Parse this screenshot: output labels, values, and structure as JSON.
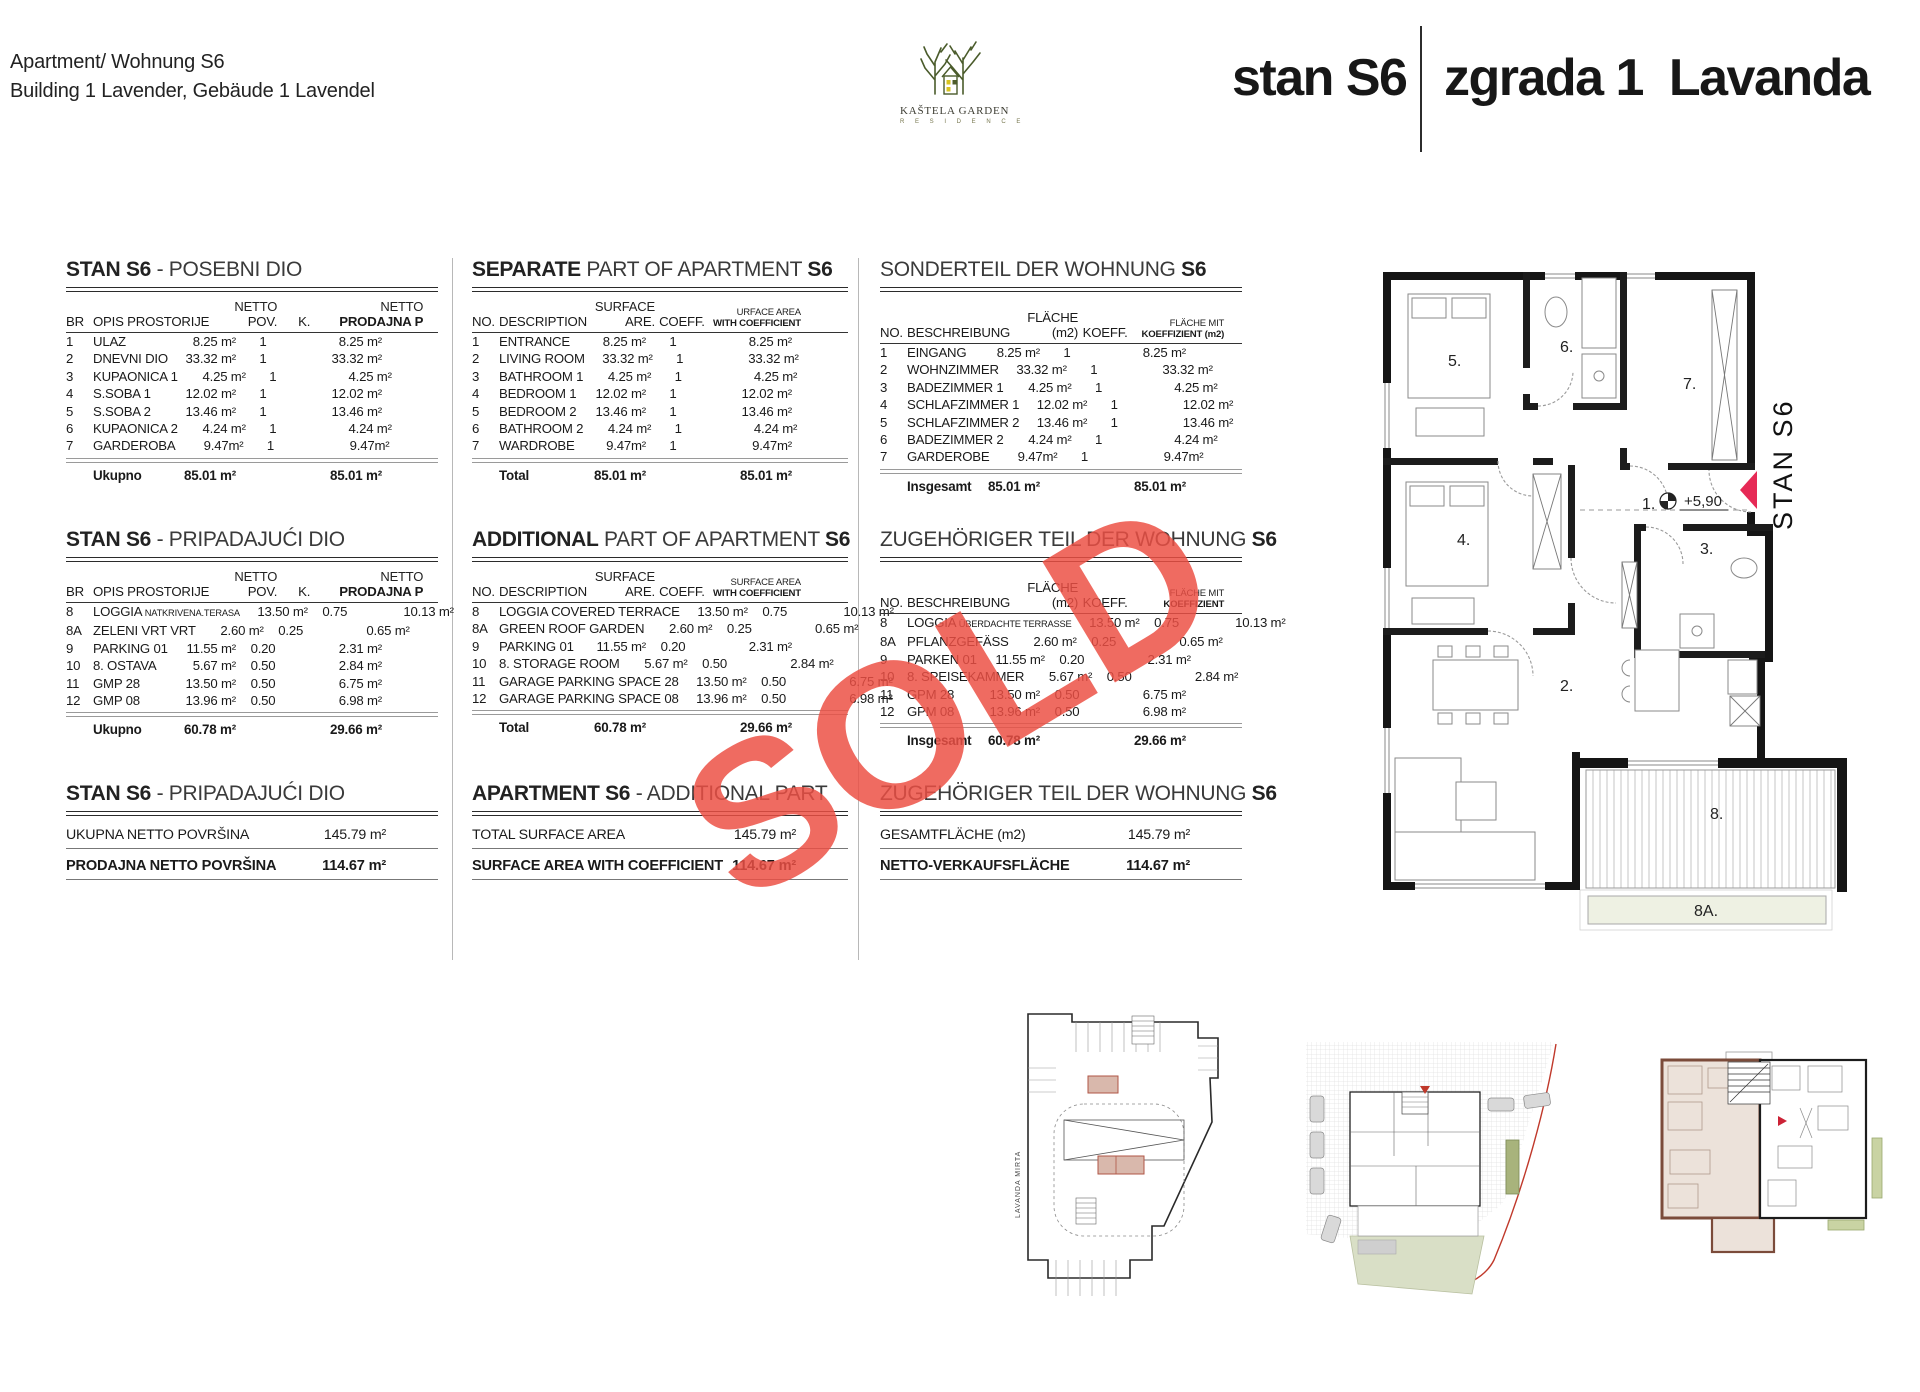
{
  "header": {
    "left_line1": "Apartment/ Wohnung S6",
    "left_line2": "Building 1 Lavender, Gebäude 1 Lavendel",
    "logo": {
      "line1": "KAŠTELA GARDEN",
      "line2": "R E S I D E N C E"
    },
    "title_unit": "stan S6",
    "title_building": "zgrada 1  Lavanda"
  },
  "watermark": {
    "text": "SOLD",
    "color": "#ec4f44"
  },
  "colors": {
    "sold_red": "#ec4f44",
    "marker_pink": "#e62a56",
    "logo_green": "#4a5b2b",
    "key_highlight_wall": "#7b4b3a",
    "key_highlight_fill": "#ece2da",
    "site_green": "#d9dfc6",
    "boundary_red": "#c0392b",
    "garage_highlight": "#d9b8ac"
  },
  "floorplan": {
    "unit_label": "STAN S6",
    "level": "+5,90",
    "rooms": {
      "r1": "1.",
      "r2": "2.",
      "r3": "3.",
      "r4": "4.",
      "r5": "5.",
      "r6": "6.",
      "r7": "7.",
      "r8": "8.",
      "r8a": "8A."
    }
  },
  "thumbnails": {
    "street_vertical": "LAVANDA    MIRTA"
  },
  "area_tables": [
    {
      "id": "hr-separate",
      "col": "hr",
      "row": "t1",
      "lang": "hr",
      "wc_small": false,
      "title": [
        {
          "t": "STAN S6",
          "b": true
        },
        {
          "t": " - POSEBNI DIO",
          "b": false
        }
      ],
      "headers": {
        "no": "BR",
        "desc": "OPIS PROSTORIJE",
        "surface_top": "NETTO",
        "surface": "POV.",
        "coeff": "K.",
        "wc_top": "NETTO",
        "wc": "PRODAJNA P"
      },
      "rows": [
        [
          "1",
          "ULAZ",
          "",
          "8.25 m²",
          "1",
          "8.25 m²"
        ],
        [
          "2",
          "DNEVNI DIO",
          "",
          "33.32 m²",
          "1",
          "33.32 m²"
        ],
        [
          "3",
          "KUPAONICA 1",
          "",
          "4.25 m²",
          "1",
          "4.25 m²"
        ],
        [
          "4",
          "S.SOBA 1",
          "",
          "12.02 m²",
          "1",
          "12.02 m²"
        ],
        [
          "5",
          "S.SOBA 2",
          "",
          "13.46 m²",
          "1",
          "13.46 m²"
        ],
        [
          "6",
          "KUPAONICA 2",
          "",
          "4.24 m²",
          "1",
          "4.24 m²"
        ],
        [
          "7",
          "GARDEROBA",
          "",
          "9.47m²",
          "1",
          "9.47m²"
        ]
      ],
      "total": {
        "label": "Ukupno",
        "surface": "85.01 m²",
        "wc": "85.01 m²"
      }
    },
    {
      "id": "en-separate",
      "col": "en",
      "row": "t1",
      "lang": "en",
      "wc_small": true,
      "title": [
        {
          "t": "SEPARATE",
          "b": true
        },
        {
          "t": " PART OF APARTMENT ",
          "b": false
        },
        {
          "t": "S6",
          "b": true
        }
      ],
      "headers": {
        "no": "NO.",
        "desc": "DESCRIPTION",
        "surface_top": "SURFACE",
        "surface": "ARE.",
        "coeff": "COEFF.",
        "wc_top": "URFACE AREA",
        "wc": "WITH COEFFICIENT"
      },
      "rows": [
        [
          "1",
          "ENTRANCE",
          "",
          "8.25 m²",
          "1",
          "8.25 m²"
        ],
        [
          "2",
          "LIVING ROOM",
          "",
          "33.32 m²",
          "1",
          "33.32 m²"
        ],
        [
          "3",
          "BATHROOM 1",
          "",
          "4.25 m²",
          "1",
          "4.25 m²"
        ],
        [
          "4",
          "BEDROOM 1",
          "",
          "12.02 m²",
          "1",
          "12.02 m²"
        ],
        [
          "5",
          "BEDROOM 2",
          "",
          "13.46 m²",
          "1",
          "13.46 m²"
        ],
        [
          "6",
          "BATHROOM 2",
          "",
          "4.24 m²",
          "1",
          "4.24 m²"
        ],
        [
          "7",
          "WARDROBE",
          "",
          "9.47m²",
          "1",
          "9.47m²"
        ]
      ],
      "total": {
        "label": "Total",
        "surface": "85.01 m²",
        "wc": "85.01 m²"
      }
    },
    {
      "id": "de-separate",
      "col": "de",
      "row": "t1",
      "lang": "de",
      "wc_small": true,
      "title": [
        {
          "t": "SONDERTEIL DER WOHNUNG ",
          "b": false
        },
        {
          "t": "S6",
          "b": true
        }
      ],
      "headers": {
        "no": "NO.",
        "desc": "BESCHREIBUNG",
        "surface_top": "",
        "surface": "FLÄCHE (m2)",
        "coeff": "KOEFF.",
        "wc_top": "FLÄCHE MIT",
        "wc": "KOEFFIZIENT (m2)"
      },
      "rows": [
        [
          "1",
          "EINGANG",
          "",
          "8.25 m²",
          "1",
          "8.25 m²"
        ],
        [
          "2",
          "WOHNZIMMER",
          "",
          "33.32 m²",
          "1",
          "33.32 m²"
        ],
        [
          "3",
          "BADEZIMMER 1",
          "",
          "4.25 m²",
          "1",
          "4.25 m²"
        ],
        [
          "4",
          "SCHLAFZIMMER 1",
          "",
          "12.02 m²",
          "1",
          "12.02 m²"
        ],
        [
          "5",
          "SCHLAFZIMMER 2",
          "",
          "13.46 m²",
          "1",
          "13.46 m²"
        ],
        [
          "6",
          "BADEZIMMER 2",
          "",
          "4.24 m²",
          "1",
          "4.24 m²"
        ],
        [
          "7",
          "GARDEROBE",
          "",
          "9.47m²",
          "1",
          "9.47m²"
        ]
      ],
      "total": {
        "label": "Insgesamt",
        "surface": "85.01 m²",
        "wc": "85.01 m²"
      }
    },
    {
      "id": "hr-additional",
      "col": "hr",
      "row": "t2",
      "lang": "hr",
      "wc_small": false,
      "title": [
        {
          "t": "STAN S6",
          "b": true
        },
        {
          "t": " - PRIPADAJUĆI DIO",
          "b": false
        }
      ],
      "headers": {
        "no": "BR",
        "desc": "OPIS PROSTORIJE",
        "surface_top": "NETTO",
        "surface": "POV.",
        "coeff": "K.",
        "wc_top": "NETTO",
        "wc": "PRODAJNA P"
      },
      "rows": [
        [
          "8",
          "LOGGIA",
          "NATKRIVENA.TERASA",
          "13.50 m²",
          "0.75",
          "10.13 m²"
        ],
        [
          "8A",
          "ZELENI VRT VRT",
          "",
          "2.60 m²",
          "0.25",
          "0.65 m²"
        ],
        [
          "9",
          "PARKING 01",
          "",
          "11.55 m²",
          "0.20",
          "2.31 m²"
        ],
        [
          "10",
          "8. OSTAVA",
          "",
          "5.67 m²",
          "0.50",
          "2.84 m²"
        ],
        [
          "11",
          "GMP 28",
          "",
          "13.50 m²",
          "0.50",
          "6.75 m²"
        ],
        [
          "12",
          "GMP 08",
          "",
          "13.96 m²",
          "0.50",
          "6.98 m²"
        ]
      ],
      "total": {
        "label": "Ukupno",
        "surface": "60.78 m²",
        "wc": "29.66 m²"
      }
    },
    {
      "id": "en-additional",
      "col": "en",
      "row": "t2",
      "lang": "en",
      "wc_small": true,
      "title": [
        {
          "t": "ADDITIONAL",
          "b": true
        },
        {
          "t": " PART OF APARTMENT ",
          "b": false
        },
        {
          "t": "S6",
          "b": true
        }
      ],
      "headers": {
        "no": "NO.",
        "desc": "DESCRIPTION",
        "surface_top": "SURFACE",
        "surface": "ARE.",
        "coeff": "COEFF.",
        "wc_top": "SURFACE AREA",
        "wc": "WITH COEFFICIENT"
      },
      "rows": [
        [
          "8",
          "LOGGIA COVERED TERRACE",
          "",
          "13.50 m²",
          "0.75",
          "10.13 m²"
        ],
        [
          "8A",
          "GREEN ROOF GARDEN",
          "",
          "2.60 m²",
          "0.25",
          "0.65 m²"
        ],
        [
          "9",
          "PARKING 01",
          "",
          "11.55 m²",
          "0.20",
          "2.31 m²"
        ],
        [
          "10",
          "8. STORAGE ROOM",
          "",
          "5.67 m²",
          "0.50",
          "2.84 m²"
        ],
        [
          "11",
          "GARAGE PARKING SPACE 28",
          "",
          "13.50 m²",
          "0.50",
          "6.75 m²"
        ],
        [
          "12",
          "GARAGE PARKING SPACE 08",
          "",
          "13.96 m²",
          "0.50",
          "6.98 m²"
        ]
      ],
      "total": {
        "label": "Total",
        "surface": "60.78 m²",
        "wc": "29.66 m²"
      }
    },
    {
      "id": "de-additional",
      "col": "de",
      "row": "t2",
      "lang": "de",
      "wc_small": true,
      "title": [
        {
          "t": "ZUGEHÖRIGER TEIL DER WOHNUNG ",
          "b": false
        },
        {
          "t": "S6",
          "b": true
        }
      ],
      "headers": {
        "no": "NO.",
        "desc": "BESCHREIBUNG",
        "surface_top": "",
        "surface": "FLÄCHE (m2)",
        "coeff": "KOEFF.",
        "wc_top": "FLÄCHE MIT",
        "wc": "KOEFFIZIENT"
      },
      "rows": [
        [
          "8",
          "LOGGIA",
          "ÜBERDACHTE TERRASSE",
          "13.50 m²",
          "0.75",
          "10.13 m²"
        ],
        [
          "8A",
          "PFLANZGEFÄSS",
          "",
          "2.60 m²",
          "0.25",
          "0.65 m²"
        ],
        [
          "9",
          "PARKEN 01",
          "",
          "11.55 m²",
          "0.20",
          "2.31 m²"
        ],
        [
          "10",
          "8. SPEISEKAMMER",
          "",
          "5.67 m²",
          "0.50",
          "2.84 m²"
        ],
        [
          "11",
          "GPM 28",
          "",
          "13.50 m²",
          "0.50",
          "6.75 m²"
        ],
        [
          "12",
          "GPM 08",
          "",
          "13.96 m²",
          "0.50",
          "6.98 m²"
        ]
      ],
      "total": {
        "label": "Insgesamt",
        "surface": "60.78 m²",
        "wc": "29.66 m²"
      }
    }
  ],
  "summary_tables": [
    {
      "id": "hr-total",
      "col": "hr",
      "title": [
        {
          "t": "STAN S6",
          "b": true
        },
        {
          "t": " - PRIPADAJUĆI DIO",
          "b": false
        }
      ],
      "rows": [
        {
          "label": "UKUPNA NETTO POVRŠINA",
          "value": "145.79 m²",
          "bold": false
        },
        {
          "label": "PRODAJNA NETTO POVRŠINA",
          "value": "114.67 m²",
          "bold": true
        }
      ]
    },
    {
      "id": "en-total",
      "col": "en",
      "title": [
        {
          "t": "APARTMENT S6",
          "b": true
        },
        {
          "t": " - ADDITIONAL PART",
          "b": false
        }
      ],
      "rows": [
        {
          "label": "TOTAL SURFACE AREA",
          "value": "145.79 m²",
          "bold": false
        },
        {
          "label": "SURFACE AREA WITH COEFFICIENT",
          "value": "114.67 m²",
          "bold": true
        }
      ]
    },
    {
      "id": "de-total",
      "col": "de",
      "title": [
        {
          "t": "ZUGEHÖRIGER TEIL DER WOHNUNG ",
          "b": false
        },
        {
          "t": "S6",
          "b": true
        }
      ],
      "rows": [
        {
          "label": "GESAMTFLÄCHE (m2)",
          "value": "145.79 m²",
          "bold": false
        },
        {
          "label": "NETTO-VERKAUFSFLÄCHE",
          "value": "114.67 m²",
          "bold": true
        }
      ]
    }
  ]
}
